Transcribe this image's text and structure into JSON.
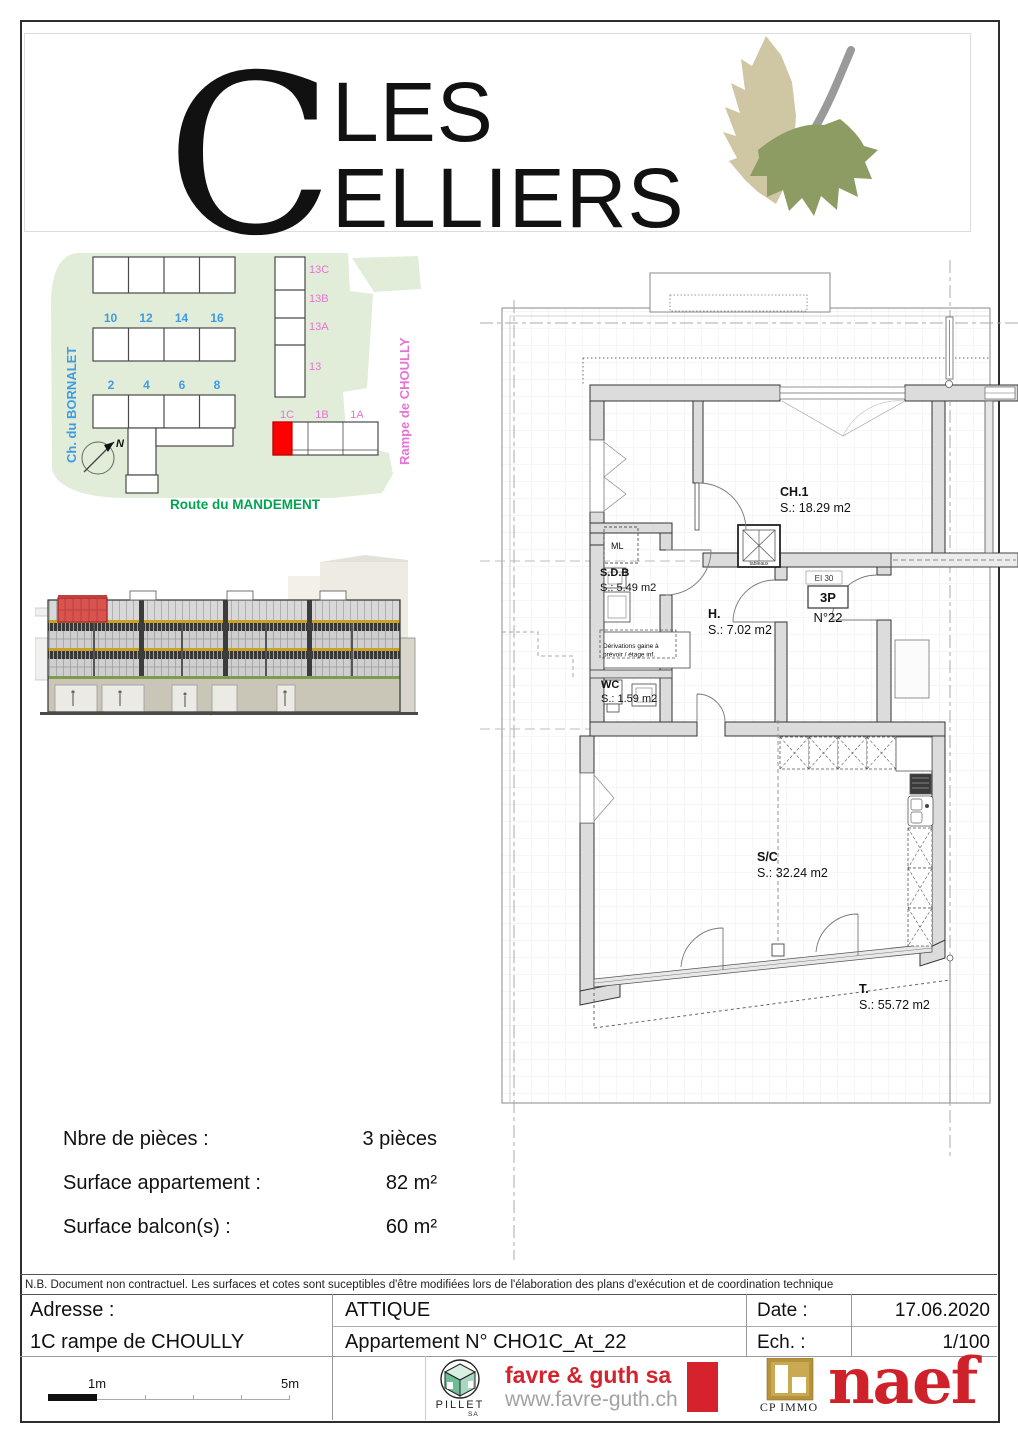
{
  "logo": {
    "initial": "C",
    "word_top": "LES",
    "word_bottom": "ELLIERS"
  },
  "site_plan": {
    "streets": {
      "left": "Ch. du BORNALET",
      "right": "Rampe de CHOULLY",
      "bottom": "Route du MANDEMENT"
    },
    "row_b": [
      "10",
      "12",
      "14",
      "16"
    ],
    "row_c": [
      "2",
      "4",
      "6",
      "8"
    ],
    "col13": [
      "13C",
      "13B",
      "13A",
      "13"
    ],
    "units1": [
      "1C",
      "1B",
      "1A"
    ],
    "compass": "N",
    "colors": {
      "map_green": "#e1edd8",
      "blue": "#3f9be2",
      "pink": "#e574d4",
      "street_green": "#00a550",
      "highlight_red": "#ff0000"
    }
  },
  "floor_plan": {
    "rooms": [
      {
        "name": "CH.1",
        "area": "S.: 18.29 m2"
      },
      {
        "name": "S.D.B",
        "area": "S.:  5.49 m2"
      },
      {
        "name": "WC",
        "area": "S.:  1.59 m2"
      },
      {
        "name": "H.",
        "area": "S.:  7.02 m2"
      },
      {
        "name": "S/C",
        "area": "S.: 32.24 m2"
      },
      {
        "name": "T.",
        "area": "S.: 55.72 m2"
      }
    ],
    "labels": {
      "ml": "ML",
      "fire_rating": "EI 30",
      "door_type": "3P",
      "door_number": "N°22",
      "shaft": "tableaux",
      "annotation_line1": "Dérivations gaine à",
      "annotation_line2": "prévoir / étage inf."
    }
  },
  "summary": {
    "rows": [
      {
        "label": "Nbre de pièces :",
        "value": "3 pièces"
      },
      {
        "label": "Surface appartement :",
        "value": "82 m²"
      },
      {
        "label": "Surface balcon(s) :",
        "value": "60 m²"
      }
    ]
  },
  "note": "N.B. Document non contractuel. Les surfaces et cotes sont suceptibles d'être modifiées lors de l'élaboration des plans d'exécution et de coordination technique",
  "details": {
    "address_label": "Adresse :",
    "address": "1C rampe de CHOULLY",
    "floor": "ATTIQUE",
    "apartment": "Appartement N° CHO1C_At_22",
    "date_label": "Date :",
    "date": "17.06.2020",
    "scale_label": "Ech. :",
    "scale": "1/100"
  },
  "footer": {
    "scale_bar": {
      "label_1m": "1m",
      "label_5m": "5m"
    },
    "pillet": {
      "name": "PILLET",
      "sub": "SA"
    },
    "favre": {
      "name": "favre & guth sa",
      "url": "www.favre-guth.ch"
    },
    "cp_immo": "CP IMMO",
    "naef": "naef"
  }
}
